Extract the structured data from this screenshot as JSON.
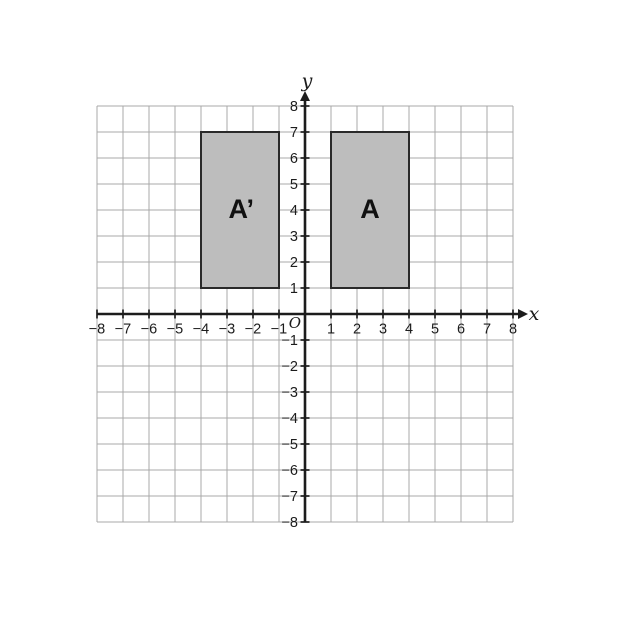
{
  "figure": {
    "canvas": {
      "width": 624,
      "height": 624,
      "bg": "#ffffff"
    },
    "plane": {
      "xmin": -8,
      "xmax": 8,
      "ymin": -8,
      "ymax": 8,
      "unit_px": 26,
      "origin_px": {
        "x": 305,
        "y": 314
      },
      "grid_color": "#a9a9a9",
      "axis_color": "#1c1c1c",
      "x_axis_label": "x",
      "y_axis_label": "y",
      "origin_label": "O",
      "x_tick_values": [
        -8,
        -7,
        -6,
        -5,
        -4,
        -3,
        -2,
        -1,
        1,
        2,
        3,
        4,
        5,
        6,
        7,
        8
      ],
      "x_tick_labels": [
        "−8",
        "−7",
        "−6",
        "−5",
        "−4",
        "−3",
        "−2",
        "−1",
        "1",
        "2",
        "3",
        "4",
        "5",
        "6",
        "7",
        "8"
      ],
      "y_tick_values": [
        -8,
        -7,
        -6,
        -5,
        -4,
        -3,
        -2,
        -1,
        1,
        2,
        3,
        4,
        5,
        6,
        7,
        8
      ],
      "y_tick_labels": [
        "−8",
        "−7",
        "−6",
        "−5",
        "−4",
        "−3",
        "−2",
        "−1",
        "1",
        "2",
        "3",
        "4",
        "5",
        "6",
        "7",
        "8"
      ]
    },
    "shapes": [
      {
        "id": "rect-A",
        "label": "A",
        "x_range": [
          1,
          4
        ],
        "y_range": [
          1,
          7
        ],
        "fill": "#bdbdbd",
        "stroke": "#2a2a2a",
        "label_pos": [
          2.5,
          4.05
        ]
      },
      {
        "id": "rect-A-prime",
        "label": "A’",
        "x_range": [
          -4,
          -1
        ],
        "y_range": [
          1,
          7
        ],
        "fill": "#bdbdbd",
        "stroke": "#2a2a2a",
        "label_pos": [
          -2.45,
          4.05
        ]
      }
    ]
  }
}
